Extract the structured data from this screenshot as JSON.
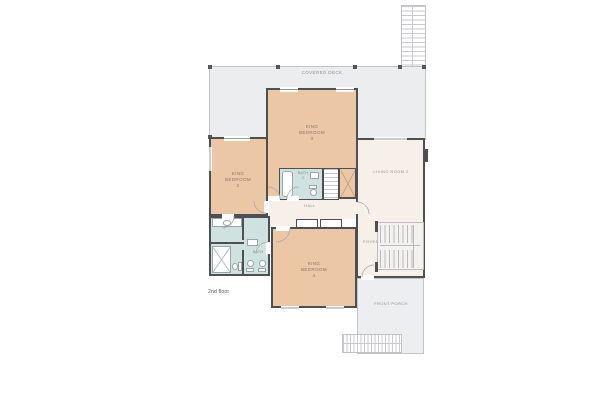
{
  "floor_label": "2nd floor",
  "rooms": {
    "covered_deck": "COVERED DECK",
    "king_bedroom_2": "KING BEDROOM 2",
    "king_bedroom_3": "KING BEDROOM 3",
    "king_bedroom_4": "KING BEDROOM 4",
    "living_room_2": "LIVING ROOM 2",
    "bath_2": "BATH 2",
    "bath": "BATH",
    "hall": "HALL",
    "foyer": "FOYER",
    "front_porch": "FRONT PORCH"
  },
  "colors": {
    "bedroom_fill": "#ecc7a5",
    "living_fill": "#f7f0e8",
    "bath_fill": "#cfe2df",
    "deck_fill": "#ebedef",
    "porch_fill": "#eceef0",
    "wall": "#4e4f52",
    "background": "#ffffff"
  }
}
